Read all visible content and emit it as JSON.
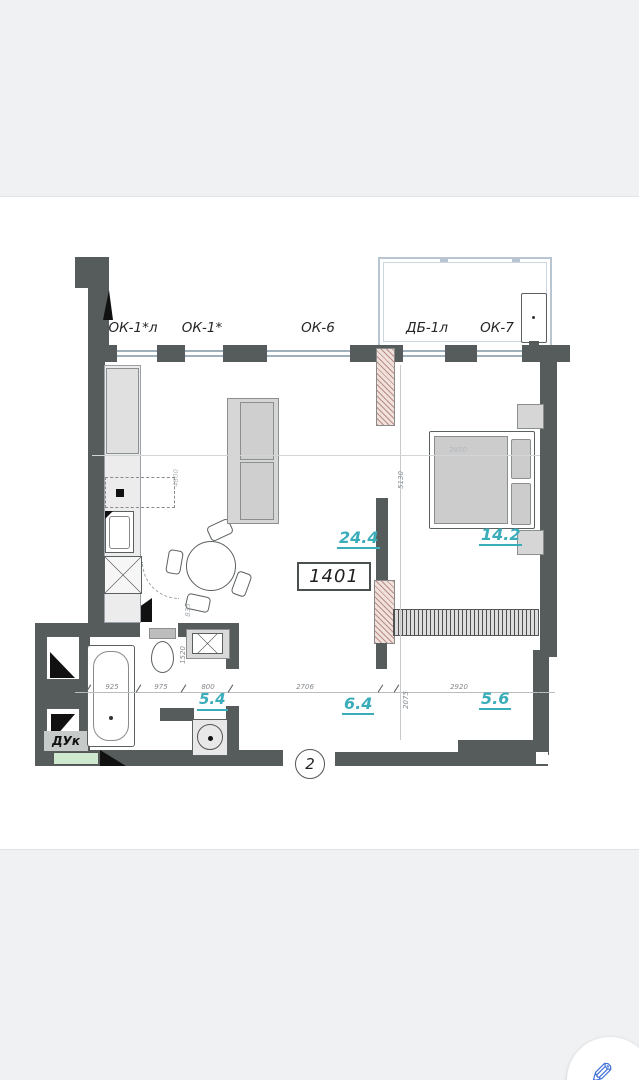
{
  "unit": {
    "number": "1401",
    "sheet_number": "2"
  },
  "window_labels": [
    "ОК-1*л",
    "ОК-1*",
    "ОК-6",
    "ДБ-1л",
    "ОК-7"
  ],
  "duct_label": "ДУк",
  "areas": {
    "kitchen_living": "24.4",
    "bedroom": "14.2",
    "bathroom": "5.4",
    "hallway": "6.4",
    "hall": "5.6"
  },
  "dimensions": {
    "h": [
      "925",
      "975",
      "800",
      "2706",
      "2920"
    ],
    "bed_width": "2850",
    "v": [
      "5130",
      "2075",
      "1520",
      "835",
      "4800"
    ]
  },
  "colors": {
    "wall": "#565b5b",
    "area_text": "#3aacba",
    "hatch": "#c2958d",
    "balcony_line": "#b9c6d1",
    "fab_icon": "#4272d8"
  },
  "fab": {
    "icon": "pencil"
  }
}
